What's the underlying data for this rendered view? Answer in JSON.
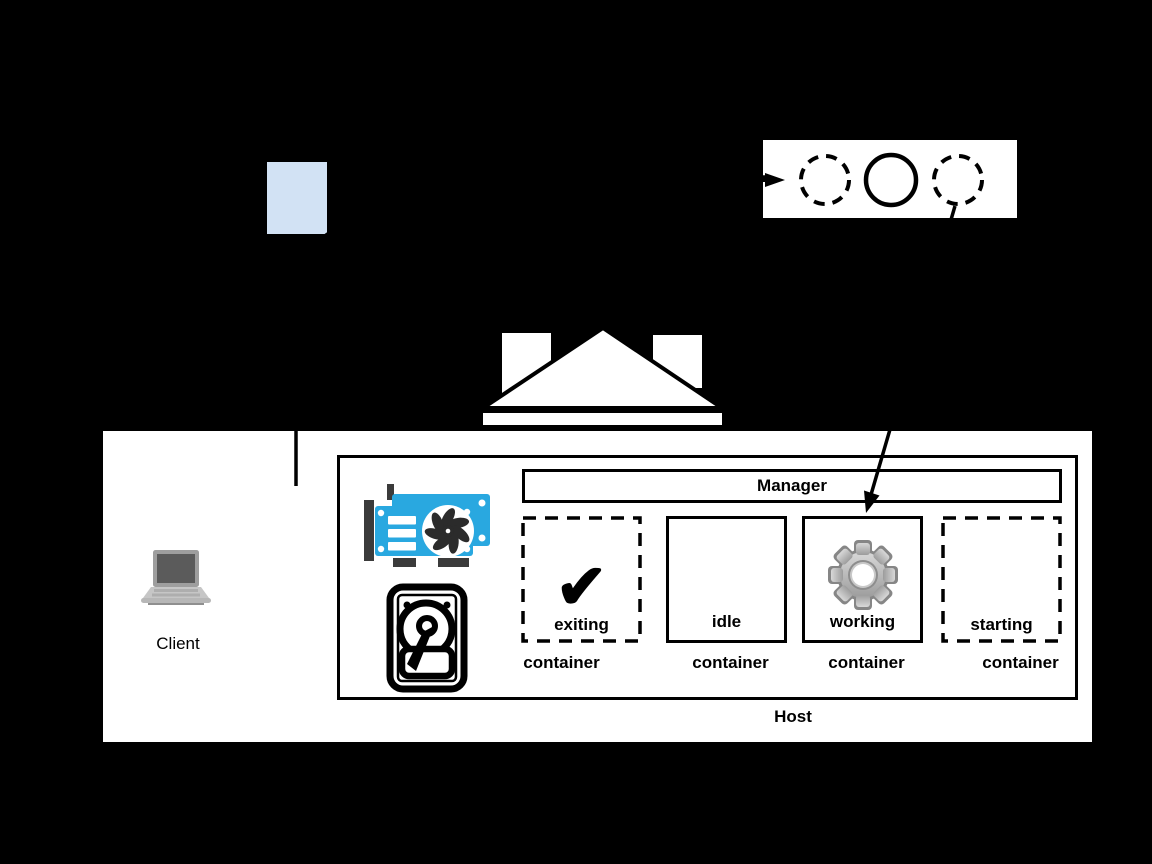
{
  "canvas": {
    "width": 1152,
    "height": 864,
    "background": "#000000"
  },
  "client": {
    "label": "Client"
  },
  "lifecycle_box": {
    "circle_styles": [
      "dashed",
      "solid",
      "dashed"
    ]
  },
  "host": {
    "label": "Host",
    "manager": {
      "label": "Manager"
    },
    "containers": [
      {
        "state": "exiting",
        "caption": "container",
        "border": "dashed",
        "icon": "checkmark-icon",
        "glyph": "✔"
      },
      {
        "state": "idle",
        "caption": "container",
        "border": "solid",
        "icon": ""
      },
      {
        "state": "working",
        "caption": "container",
        "border": "solid",
        "icon": "gear-icon"
      },
      {
        "state": "starting",
        "caption": "container",
        "border": "dashed",
        "icon": ""
      }
    ]
  },
  "icons": {
    "gpu": "gpu-card-icon",
    "disk": "hard-drive-icon",
    "laptop": "laptop-icon",
    "document": "document-icon"
  },
  "colors": {
    "document_fill": "#d2e2f4",
    "gpu_blue": "#29a8e0",
    "icon_dark": "#3b3b3b",
    "gear_gray": "#b8b8b8",
    "line": "#000000",
    "panel": "#ffffff"
  }
}
